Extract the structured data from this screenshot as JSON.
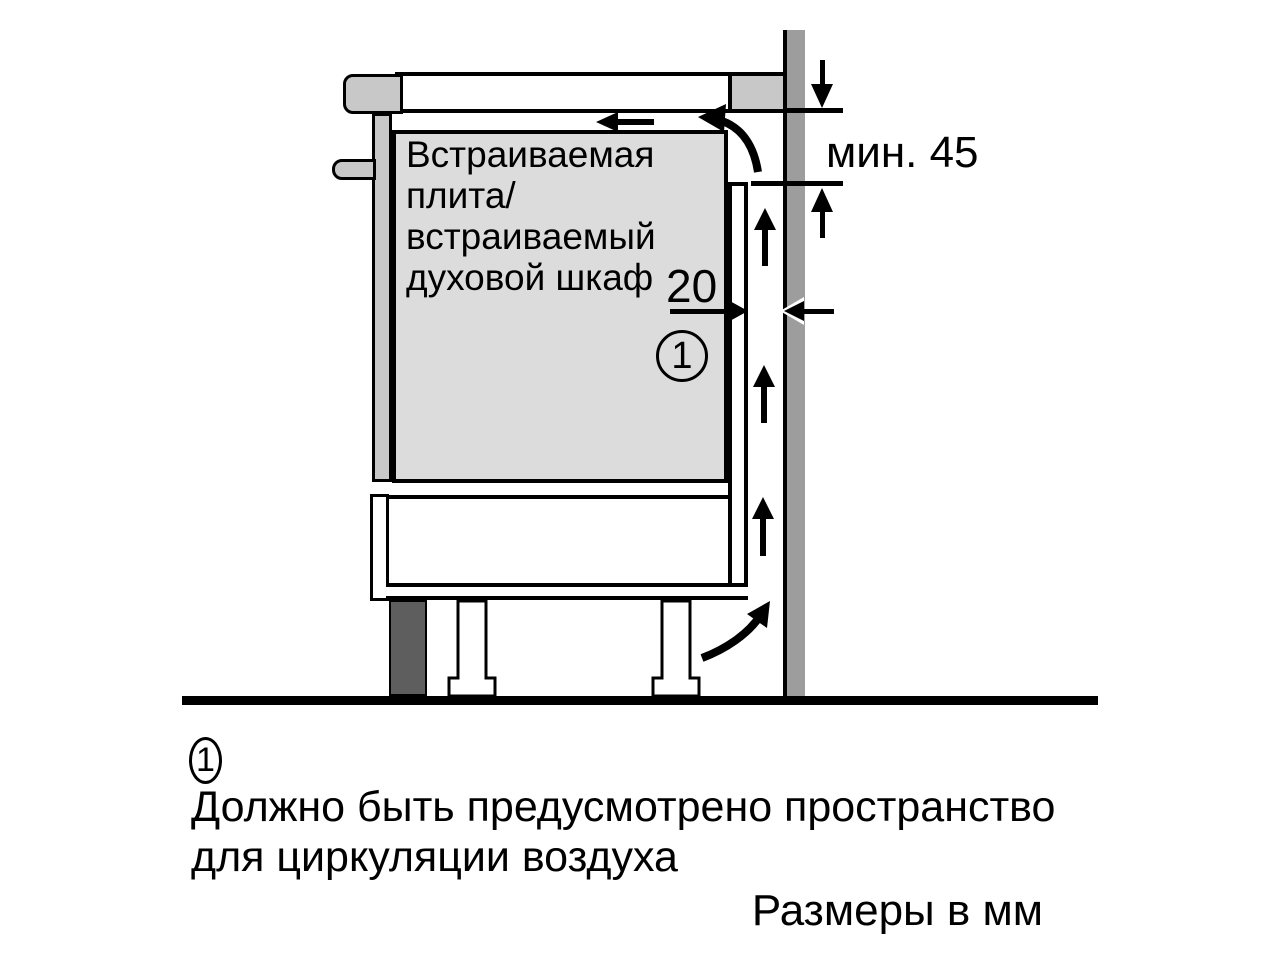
{
  "diagram": {
    "appliance_label": "Встраиваемая\nплита/\nвстраиваемый\nдуховой шкаф",
    "gap_dimension": "20",
    "min_clearance": "мин. 45",
    "callout_number": "1"
  },
  "caption": {
    "footnote_number": "1",
    "footnote_text": "Должно быть предусмотрено пространство\nдля циркуляции воздуха",
    "units_note": "Размеры в мм"
  },
  "colors": {
    "line": "#000000",
    "appliance_fill": "#dcdcdc",
    "trim_fill": "#c8c8c8",
    "wall_fill": "#9d9d9d",
    "plinth_fill": "#5e5e5e",
    "background": "#ffffff"
  }
}
